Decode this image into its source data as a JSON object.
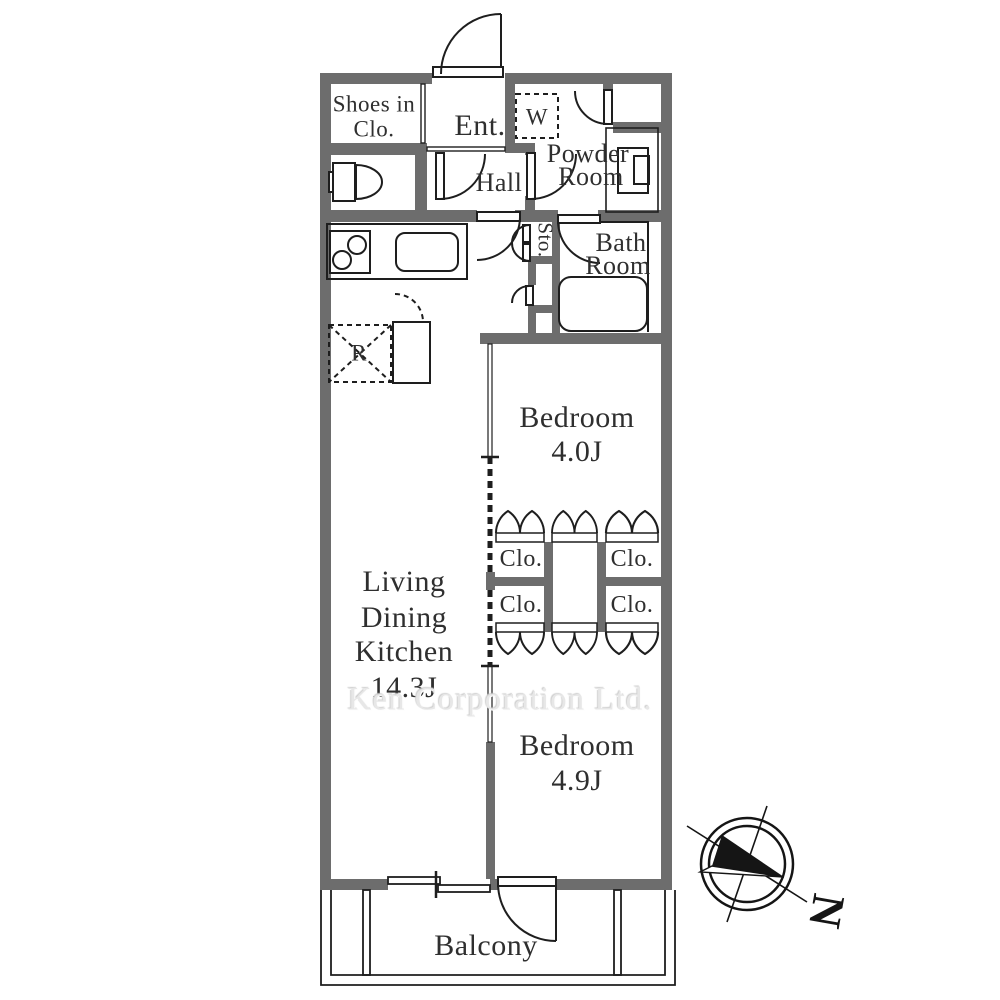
{
  "colors": {
    "wall_gray": "#6d6d6d",
    "line_black": "#1e1e1e",
    "label_text": "#2f2f2f",
    "watermark_gray": "#e7e7e7"
  },
  "labels": {
    "shoes_closet": {
      "line1": "Shoes in",
      "line2": "Clo."
    },
    "entrance": "Ent.",
    "washer": "W",
    "powder_room": {
      "line1": "Powder",
      "line2": "Room"
    },
    "hall": "Hall",
    "storage": "Sto.",
    "bath_room": {
      "line1": "Bath",
      "line2": "Room"
    },
    "bedroom_1": {
      "name": "Bedroom",
      "size": "4.0J"
    },
    "closet_top_left": "Clo.",
    "closet_top_right": "Clo.",
    "closet_bottom_left": "Clo.",
    "closet_bottom_right": "Clo.",
    "ldk": {
      "line1": "Living",
      "line2": "Dining",
      "line3": "Kitchen",
      "size": "14.3J"
    },
    "bedroom_2": {
      "name": "Bedroom",
      "size": "4.9J"
    },
    "balcony": "Balcony",
    "refrigerator": "R",
    "compass_north": "N",
    "watermark": "Ken Corporation Ltd."
  }
}
